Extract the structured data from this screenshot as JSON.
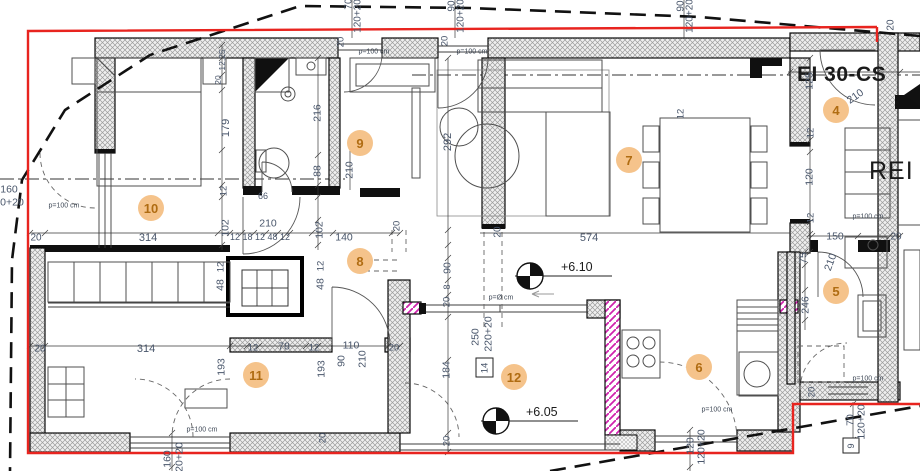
{
  "plan": {
    "fire_rating_door": "EI 30-CS",
    "fire_rating_wall": "REI",
    "levels": [
      {
        "label": "+6.10"
      },
      {
        "label": "+6.05"
      }
    ],
    "room_badges": [
      {
        "n": "4",
        "x": 836,
        "y": 110
      },
      {
        "n": "5",
        "x": 836,
        "y": 291
      },
      {
        "n": "6",
        "x": 699,
        "y": 367
      },
      {
        "n": "7",
        "x": 629,
        "y": 160
      },
      {
        "n": "8",
        "x": 360,
        "y": 261
      },
      {
        "n": "9",
        "x": 360,
        "y": 143
      },
      {
        "n": "10",
        "x": 151,
        "y": 208
      },
      {
        "n": "11",
        "x": 256,
        "y": 375
      },
      {
        "n": "12",
        "x": 514,
        "y": 377
      }
    ],
    "dimension_labels": [
      {
        "t": "70",
        "x": 348,
        "y": 4,
        "r": -90,
        "s": 10
      },
      {
        "t": "120+20",
        "x": 357,
        "y": 16,
        "r": -90,
        "s": 10
      },
      {
        "t": "90",
        "x": 451,
        "y": 6,
        "r": -90,
        "s": 10
      },
      {
        "t": "120+20",
        "x": 460,
        "y": 16,
        "r": -90,
        "s": 10
      },
      {
        "t": "90",
        "x": 680,
        "y": 6,
        "r": -90,
        "s": 10
      },
      {
        "t": "120+20",
        "x": 689,
        "y": 16,
        "r": -90,
        "s": 10
      },
      {
        "t": "20",
        "x": 890,
        "y": 25,
        "r": -90,
        "s": 10
      },
      {
        "t": "20",
        "x": 340,
        "y": 42,
        "r": -90,
        "s": 9.5
      },
      {
        "t": "20",
        "x": 444,
        "y": 41,
        "r": -90,
        "s": 9.5
      },
      {
        "t": "12,25",
        "x": 222,
        "y": 60,
        "r": -90,
        "s": 8.5
      },
      {
        "t": "20",
        "x": 218,
        "y": 80,
        "r": -90,
        "s": 8.5
      },
      {
        "t": "179",
        "x": 225,
        "y": 128,
        "r": -90,
        "s": 11
      },
      {
        "t": "12",
        "x": 223,
        "y": 191,
        "r": -90,
        "s": 9.5
      },
      {
        "t": "102",
        "x": 225,
        "y": 228,
        "r": -90,
        "s": 10.5
      },
      {
        "t": "160",
        "x": 9,
        "y": 189,
        "r": 0,
        "s": 10.5
      },
      {
        "t": "0+20",
        "x": 12,
        "y": 202,
        "r": 0,
        "s": 10.5
      },
      {
        "t": "20",
        "x": 36,
        "y": 237,
        "r": 0,
        "s": 10
      },
      {
        "t": "314",
        "x": 148,
        "y": 237,
        "r": 0,
        "s": 11
      },
      {
        "t": "12 18 12 48 12",
        "x": 260,
        "y": 237,
        "r": 0,
        "s": 9
      },
      {
        "t": "102",
        "x": 319,
        "y": 230,
        "r": -90,
        "s": 10.5
      },
      {
        "t": "140",
        "x": 344,
        "y": 237,
        "r": 0,
        "s": 10.5
      },
      {
        "t": "20",
        "x": 497,
        "y": 232,
        "r": -90,
        "s": 10
      },
      {
        "t": "216",
        "x": 317,
        "y": 113,
        "r": -90,
        "s": 10.5
      },
      {
        "t": "66",
        "x": 263,
        "y": 196,
        "r": 0,
        "s": 9
      },
      {
        "t": "210",
        "x": 268,
        "y": 223,
        "r": 0,
        "s": 10.5
      },
      {
        "t": "88",
        "x": 317,
        "y": 171,
        "r": -90,
        "s": 10.5
      },
      {
        "t": "210",
        "x": 349,
        "y": 170,
        "r": -90,
        "s": 10.5
      },
      {
        "t": "292",
        "x": 447,
        "y": 142,
        "r": -90,
        "s": 11
      },
      {
        "t": "574",
        "x": 589,
        "y": 237,
        "r": 0,
        "s": 11
      },
      {
        "t": "12",
        "x": 680,
        "y": 114,
        "r": -90,
        "s": 9.5
      },
      {
        "t": "125",
        "x": 809,
        "y": 81,
        "r": -90,
        "s": 10.5
      },
      {
        "t": "12",
        "x": 810,
        "y": 133,
        "r": -90,
        "s": 9.5
      },
      {
        "t": "120",
        "x": 809,
        "y": 177,
        "r": -90,
        "s": 10.5
      },
      {
        "t": "12",
        "x": 810,
        "y": 218,
        "r": -90,
        "s": 9.5
      },
      {
        "t": "150",
        "x": 835,
        "y": 236,
        "r": 0,
        "s": 10.5
      },
      {
        "t": "20",
        "x": 896,
        "y": 236,
        "r": 0,
        "s": 10
      },
      {
        "t": "210",
        "x": 855,
        "y": 96,
        "r": -35,
        "s": 10.5
      },
      {
        "t": "75",
        "x": 803,
        "y": 258,
        "r": -90,
        "s": 10.5
      },
      {
        "t": "246",
        "x": 805,
        "y": 305,
        "r": -90,
        "s": 10.5
      },
      {
        "t": "210",
        "x": 830,
        "y": 262,
        "r": -70,
        "s": 10.5
      },
      {
        "t": "20",
        "x": 811,
        "y": 392,
        "r": -90,
        "s": 9.5
      },
      {
        "t": "70",
        "x": 850,
        "y": 420,
        "r": -90,
        "s": 10.5
      },
      {
        "t": "120+20",
        "x": 861,
        "y": 422,
        "r": -90,
        "s": 10.5
      },
      {
        "t": "120",
        "x": 690,
        "y": 446,
        "r": -90,
        "s": 10.5
      },
      {
        "t": "120+20",
        "x": 701,
        "y": 447,
        "r": -90,
        "s": 10.5
      },
      {
        "t": "90",
        "x": 447,
        "y": 268,
        "r": -90,
        "s": 10.5
      },
      {
        "t": "8",
        "x": 447,
        "y": 287,
        "r": -90,
        "s": 9
      },
      {
        "t": "20",
        "x": 446,
        "y": 302,
        "r": -90,
        "s": 9.5
      },
      {
        "t": "20",
        "x": 396,
        "y": 226,
        "r": -90,
        "s": 9.5
      },
      {
        "t": "250",
        "x": 475,
        "y": 337,
        "r": -90,
        "s": 10.5
      },
      {
        "t": "220+20",
        "x": 488,
        "y": 334,
        "r": -90,
        "s": 10.5
      },
      {
        "t": "184",
        "x": 446,
        "y": 370,
        "r": -90,
        "s": 10.5
      },
      {
        "t": "20",
        "x": 446,
        "y": 441,
        "r": -90,
        "s": 9.5
      },
      {
        "t": "20",
        "x": 322,
        "y": 438,
        "r": -90,
        "s": 9.5
      },
      {
        "t": "20",
        "x": 40,
        "y": 348,
        "r": 0,
        "s": 10
      },
      {
        "t": "314",
        "x": 146,
        "y": 348,
        "r": 0,
        "s": 11
      },
      {
        "t": "12",
        "x": 253,
        "y": 347,
        "r": 0,
        "s": 9.5
      },
      {
        "t": "78",
        "x": 284,
        "y": 346,
        "r": 0,
        "s": 10.5
      },
      {
        "t": "12",
        "x": 314,
        "y": 347,
        "r": 0,
        "s": 9.5
      },
      {
        "t": "110",
        "x": 351,
        "y": 345,
        "r": 0,
        "s": 10.5
      },
      {
        "t": "20",
        "x": 394,
        "y": 347,
        "r": 0,
        "s": 9.5
      },
      {
        "t": "193",
        "x": 221,
        "y": 367,
        "r": -90,
        "s": 10.5
      },
      {
        "t": "193",
        "x": 321,
        "y": 369,
        "r": -90,
        "s": 10.5
      },
      {
        "t": "90",
        "x": 341,
        "y": 361,
        "r": -90,
        "s": 10.5
      },
      {
        "t": "210",
        "x": 362,
        "y": 359,
        "r": -90,
        "s": 10.5
      },
      {
        "t": "12",
        "x": 320,
        "y": 266,
        "r": -90,
        "s": 9.5
      },
      {
        "t": "48",
        "x": 320,
        "y": 284,
        "r": -90,
        "s": 10.5
      },
      {
        "t": "12",
        "x": 220,
        "y": 267,
        "r": -90,
        "s": 9.5
      },
      {
        "t": "48",
        "x": 220,
        "y": 285,
        "r": -90,
        "s": 10.5
      },
      {
        "t": "160",
        "x": 167,
        "y": 459,
        "r": -90,
        "s": 10.5
      },
      {
        "t": "120+20",
        "x": 179,
        "y": 460,
        "r": -90,
        "s": 10.5
      }
    ],
    "parapet_labels": [
      {
        "t": "p=100 cm",
        "x": 64,
        "y": 205
      },
      {
        "t": "p=100 cm",
        "x": 374,
        "y": 51
      },
      {
        "t": "p=100 cm",
        "x": 472,
        "y": 51
      },
      {
        "t": "p=Ø cm",
        "x": 501,
        "y": 297
      },
      {
        "t": "p=100 cm",
        "x": 202,
        "y": 429
      },
      {
        "t": "p=100 cm",
        "x": 717,
        "y": 409
      },
      {
        "t": "p=100 cm",
        "x": 868,
        "y": 378
      },
      {
        "t": "p=100 cm",
        "x": 868,
        "y": 216
      }
    ],
    "box_marks": [
      {
        "t": "14",
        "x": 484,
        "y": 368,
        "r": -90,
        "s": 9.5
      },
      {
        "t": "9",
        "x": 851,
        "y": 446,
        "r": -90,
        "s": 9
      }
    ]
  }
}
